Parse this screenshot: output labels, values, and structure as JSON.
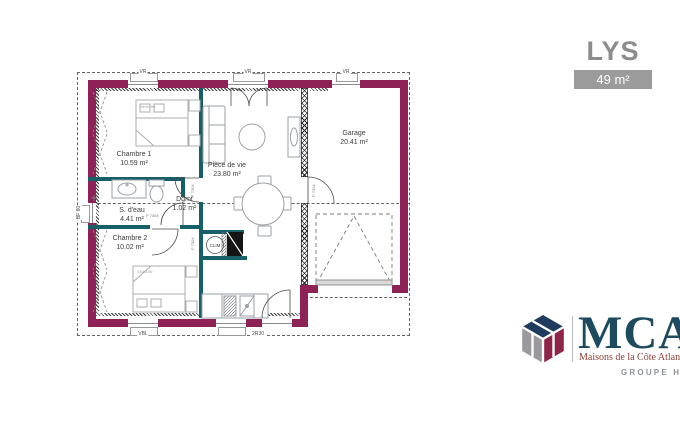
{
  "header": {
    "title": "LYS",
    "area": "49 m²"
  },
  "plan": {
    "rooms": [
      {
        "id": "chambre1",
        "name": "Chambre 1",
        "area": "10.59 m²"
      },
      {
        "id": "piece_de_vie",
        "name": "Pièce de vie",
        "area": "23.80 m²"
      },
      {
        "id": "garage",
        "name": "Garage",
        "area": "20.41 m²"
      },
      {
        "id": "s_deau",
        "name": "S. d'eau",
        "area": "4.41 m²"
      },
      {
        "id": "dgmt",
        "name": "Dgmt",
        "area": "1.02 m²"
      },
      {
        "id": "chambre2",
        "name": "Chambre 2",
        "area": "10.02 m²"
      }
    ],
    "annotations": {
      "clim": "CLIM",
      "bed_size": "140x190",
      "door_tag": "P 7304"
    },
    "dim_labels": {
      "top_1": "VR",
      "top_2": "VR",
      "top_3": "VR",
      "left": "BF 60",
      "bottom_1": "VBL",
      "bottom_2": "2R30"
    },
    "colors": {
      "exterior_wall": "#8e2155",
      "partition": "#175f69"
    }
  },
  "logo": {
    "brand": "MCA",
    "tagline": "Maisons de la Côte Atlantique",
    "group": "GROUPE HEXAOM",
    "colors": {
      "navy": "#1f3b5e",
      "gray": "#9a9a9e",
      "maroon": "#8e2548"
    }
  }
}
